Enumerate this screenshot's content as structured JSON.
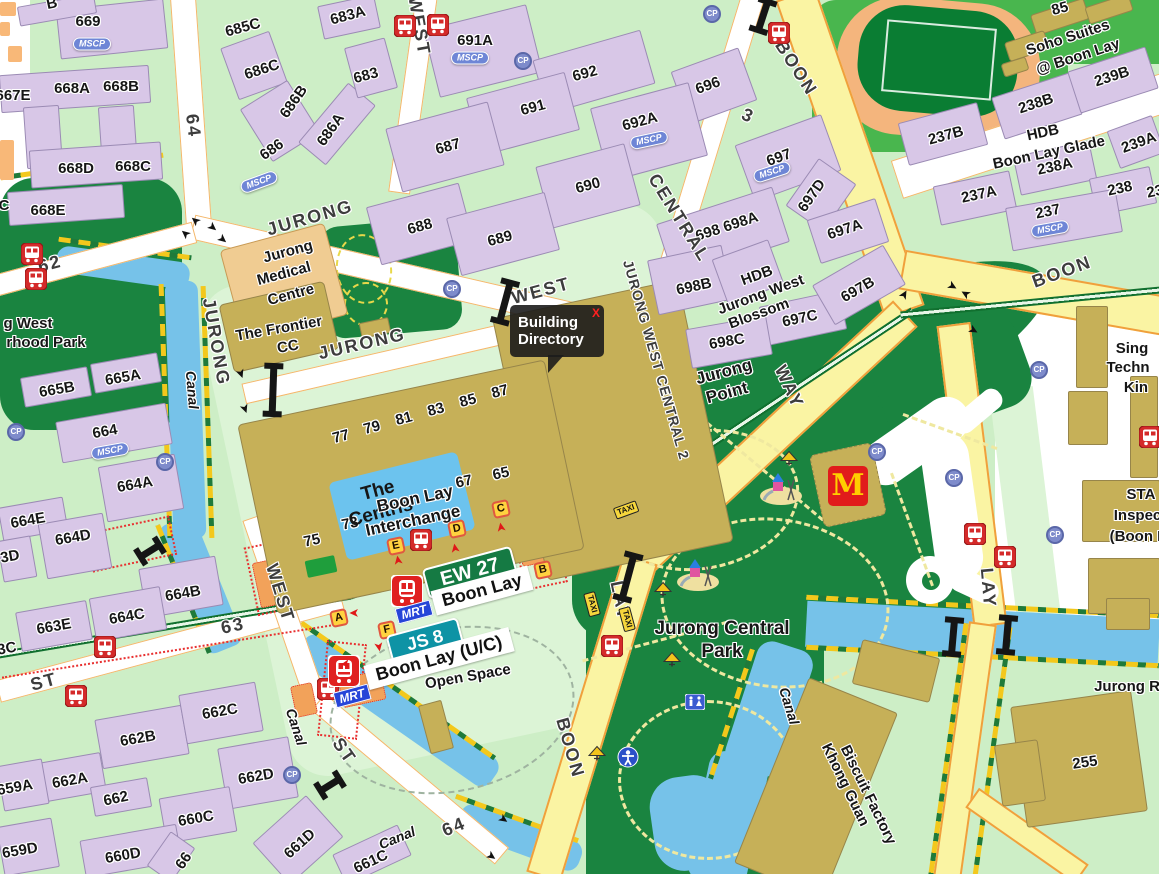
{
  "tooltip": {
    "line1": "Building",
    "line2": "Directory",
    "close": "X"
  },
  "stations": {
    "ew_code": "EW 27",
    "ew_name": "Boon Lay",
    "js_code": "JS 8",
    "js_name": "Boon Lay (U/C)",
    "mrt_label": "MRT"
  },
  "badge_text": {
    "mscp": "MSCP",
    "cp": "CP",
    "taxi": "TAXI",
    "mrtbar": "MRT",
    "mcd": "M"
  },
  "colors": {
    "expressway": "#faf4a3",
    "mrt_line": "#11702f",
    "park": "#1a8440",
    "canal": "#76c2e9",
    "hdb_block": "#d8c7e7",
    "commercial": "#c6b058",
    "ew_line_badge": "#157a43",
    "jrl_badge": "#0e93a5",
    "bus_red": "#d42a2a",
    "mcd_red": "#e11b1b"
  },
  "labels": [
    [
      "B",
      52,
      4,
      -12,
      "blk"
    ],
    [
      "669",
      88,
      22,
      0,
      "blk"
    ],
    [
      "685C",
      243,
      28,
      -15,
      "blk"
    ],
    [
      "683A",
      348,
      16,
      -15,
      "blk"
    ],
    [
      "686C",
      262,
      70,
      -18,
      "blk"
    ],
    [
      "683",
      366,
      76,
      -15,
      "blk"
    ],
    [
      "686B",
      294,
      102,
      -55,
      "blk"
    ],
    [
      "686A",
      331,
      130,
      -55,
      "blk"
    ],
    [
      "686",
      272,
      150,
      -35,
      "blk"
    ],
    [
      "667E",
      13,
      96,
      0,
      "blk"
    ],
    [
      "668A",
      72,
      89,
      0,
      "blk"
    ],
    [
      "668B",
      121,
      87,
      0,
      "blk"
    ],
    [
      "668D",
      76,
      169,
      0,
      "blk"
    ],
    [
      "668C",
      133,
      167,
      0,
      "blk"
    ],
    [
      "C",
      4,
      206,
      0,
      "blk"
    ],
    [
      "668E",
      48,
      211,
      0,
      "blk"
    ],
    [
      "691A",
      475,
      41,
      0,
      "blk"
    ],
    [
      "692",
      585,
      74,
      -15,
      "blk"
    ],
    [
      "691",
      533,
      108,
      -15,
      "blk"
    ],
    [
      "696",
      708,
      86,
      -20,
      "blk"
    ],
    [
      "687",
      448,
      147,
      -15,
      "blk"
    ],
    [
      "692A",
      640,
      122,
      -15,
      "blk"
    ],
    [
      "690",
      588,
      186,
      -15,
      "blk"
    ],
    [
      "688",
      420,
      227,
      -15,
      "blk"
    ],
    [
      "689",
      500,
      239,
      -15,
      "blk"
    ],
    [
      "697",
      779,
      158,
      -20,
      "blk"
    ],
    [
      "697D",
      812,
      196,
      -55,
      "blk"
    ],
    [
      "698 698A",
      727,
      227,
      -18,
      "blk"
    ],
    [
      "697A",
      845,
      230,
      -18,
      "blk"
    ],
    [
      "698B",
      694,
      287,
      -12,
      "blk"
    ],
    [
      "697C",
      800,
      319,
      -12,
      "blk"
    ],
    [
      "697B",
      858,
      290,
      -30,
      "blk"
    ],
    [
      "698C",
      727,
      342,
      -10,
      "blk"
    ],
    [
      "85",
      1060,
      9,
      -15,
      "blk"
    ],
    [
      "239B",
      1112,
      77,
      -18,
      "blk"
    ],
    [
      "238B",
      1036,
      104,
      -18,
      "blk"
    ],
    [
      "237B",
      946,
      136,
      -15,
      "blk"
    ],
    [
      "239A",
      1139,
      143,
      -20,
      "blk"
    ],
    [
      "238A",
      1055,
      167,
      -12,
      "blk"
    ],
    [
      "237A",
      979,
      195,
      -12,
      "blk"
    ],
    [
      "238",
      1120,
      189,
      -12,
      "blk"
    ],
    [
      "23",
      1155,
      192,
      -12,
      "blk"
    ],
    [
      "237",
      1048,
      212,
      -12,
      "blk"
    ],
    [
      "665B",
      57,
      390,
      -10,
      "blk"
    ],
    [
      "665A",
      123,
      378,
      -10,
      "blk"
    ],
    [
      "664",
      105,
      432,
      -10,
      "blk"
    ],
    [
      "664A",
      135,
      485,
      -10,
      "blk"
    ],
    [
      "664E",
      28,
      521,
      -10,
      "blk"
    ],
    [
      "664D",
      73,
      538,
      -10,
      "blk"
    ],
    [
      "3D",
      10,
      557,
      -10,
      "blk"
    ],
    [
      "664B",
      183,
      594,
      -10,
      "blk"
    ],
    [
      "664C",
      127,
      617,
      -10,
      "blk"
    ],
    [
      "663E",
      54,
      627,
      -10,
      "blk"
    ],
    [
      "3C",
      7,
      649,
      -10,
      "blk"
    ],
    [
      "662B",
      138,
      739,
      -10,
      "blk"
    ],
    [
      "662C",
      220,
      712,
      -10,
      "blk"
    ],
    [
      "662A",
      70,
      781,
      -10,
      "blk"
    ],
    [
      "662",
      116,
      799,
      -12,
      "blk"
    ],
    [
      "662D",
      256,
      777,
      -10,
      "blk"
    ],
    [
      "660C",
      196,
      819,
      -10,
      "blk"
    ],
    [
      "660D",
      123,
      856,
      -10,
      "blk"
    ],
    [
      "659A",
      15,
      788,
      -10,
      "blk"
    ],
    [
      "659D",
      20,
      851,
      -10,
      "blk"
    ],
    [
      "661D",
      300,
      844,
      -42,
      "blk"
    ],
    [
      "661C",
      371,
      862,
      -25,
      "blk"
    ],
    [
      "66",
      184,
      861,
      -55,
      "blk"
    ],
    [
      "255",
      1085,
      763,
      -8,
      "blk"
    ],
    [
      "Jurong R",
      1127,
      687,
      0,
      "blk"
    ],
    [
      "77",
      341,
      437,
      -15,
      "blk"
    ],
    [
      "79",
      372,
      428,
      -15,
      "blk"
    ],
    [
      "81",
      404,
      419,
      -15,
      "blk"
    ],
    [
      "83",
      436,
      410,
      -15,
      "blk"
    ],
    [
      "85",
      468,
      401,
      -15,
      "blk"
    ],
    [
      "87",
      500,
      392,
      -15,
      "blk"
    ],
    [
      "75",
      312,
      541,
      -12,
      "blk"
    ],
    [
      "73",
      350,
      524,
      -12,
      "blk"
    ],
    [
      "67",
      464,
      482,
      -12,
      "blk"
    ],
    [
      "65",
      501,
      474,
      -12,
      "blk"
    ],
    [
      "Jurong",
      288,
      252,
      -15,
      "area"
    ],
    [
      "Medical",
      284,
      274,
      -15,
      "area"
    ],
    [
      "Centre",
      291,
      295,
      -15,
      "area"
    ],
    [
      "The Frontier",
      279,
      329,
      -10,
      "area"
    ],
    [
      "CC",
      288,
      347,
      -10,
      "area"
    ],
    [
      "The",
      378,
      491,
      -15,
      "cent"
    ],
    [
      "Centris",
      381,
      513,
      -15,
      "cent"
    ],
    [
      "Boon Lay",
      415,
      499,
      -12,
      "areaL"
    ],
    [
      "Interchange",
      413,
      521,
      -12,
      "areaL"
    ],
    [
      "Jurong",
      724,
      372,
      -15,
      "areaL"
    ],
    [
      "Point",
      727,
      393,
      -15,
      "areaL"
    ],
    [
      "HDB",
      757,
      276,
      -20,
      "area"
    ],
    [
      "Jurong West",
      761,
      295,
      -20,
      "area"
    ],
    [
      "Blossom",
      759,
      314,
      -20,
      "area"
    ],
    [
      "HDB",
      1043,
      133,
      -12,
      "area"
    ],
    [
      "Boon Lay Glade",
      1049,
      153,
      -12,
      "area"
    ],
    [
      "Soho Suites",
      1068,
      38,
      -18,
      "area"
    ],
    [
      "@ Boon Lay",
      1078,
      57,
      -18,
      "area"
    ],
    [
      "Jurong Central",
      722,
      629,
      0,
      "park1"
    ],
    [
      "Park",
      722,
      652,
      0,
      "park1"
    ],
    [
      "Open Space",
      468,
      677,
      -10,
      "area"
    ],
    [
      "g West",
      28,
      324,
      0,
      "area"
    ],
    [
      "rhood Park",
      46,
      343,
      0,
      "area"
    ],
    [
      "Sing",
      1132,
      349,
      0,
      "area"
    ],
    [
      "Techn",
      1128,
      368,
      0,
      "area"
    ],
    [
      "Kin",
      1136,
      388,
      0,
      "area"
    ],
    [
      "STA",
      1141,
      495,
      0,
      "area"
    ],
    [
      "Inspect",
      1140,
      516,
      0,
      "area"
    ],
    [
      "(Boon L",
      1138,
      537,
      0,
      "area"
    ],
    [
      "Khong Guan",
      845,
      785,
      64,
      "fact"
    ],
    [
      "Biscuit Factory",
      868,
      795,
      64,
      "fact"
    ],
    [
      "Canal",
      192,
      390,
      85,
      "canalL"
    ],
    [
      "Canal",
      296,
      727,
      72,
      "canalL"
    ],
    [
      "Canal",
      397,
      838,
      -22,
      "canalL"
    ],
    [
      "Canal",
      789,
      706,
      73,
      "canalL"
    ],
    [
      "64",
      193,
      126,
      83,
      "road"
    ],
    [
      "62",
      50,
      264,
      -15,
      "road"
    ],
    [
      "JURONG",
      216,
      342,
      80,
      "road"
    ],
    [
      "JURONG",
      310,
      218,
      -16,
      "road"
    ],
    [
      "JURONG",
      362,
      344,
      -13,
      "road"
    ],
    [
      "WEST",
      541,
      291,
      -15,
      "road"
    ],
    [
      "WEST",
      419,
      26,
      80,
      "road"
    ],
    [
      "JURONG WEST CENTRAL 2",
      656,
      360,
      74,
      "roadS"
    ],
    [
      "CENTRAL",
      679,
      218,
      58,
      "road"
    ],
    [
      "3",
      748,
      116,
      25,
      "road"
    ],
    [
      "BOON",
      796,
      68,
      57,
      "road"
    ],
    [
      "WAY",
      789,
      387,
      65,
      "road"
    ],
    [
      "LAY",
      620,
      601,
      78,
      "road"
    ],
    [
      "BOON",
      570,
      748,
      74,
      "road"
    ],
    [
      "BOON",
      1062,
      272,
      -20,
      "road"
    ],
    [
      "LAY",
      988,
      588,
      85,
      "road"
    ],
    [
      "WEST",
      280,
      593,
      73,
      "road"
    ],
    [
      "ST",
      44,
      682,
      -15,
      "road"
    ],
    [
      "63",
      233,
      626,
      -12,
      "road"
    ],
    [
      "ST",
      344,
      751,
      55,
      "road"
    ],
    [
      "64",
      454,
      827,
      -22,
      "road"
    ]
  ],
  "badges": [
    [
      "mscp",
      92,
      44,
      0,
      null
    ],
    [
      "mscp",
      259,
      182,
      -20,
      null
    ],
    [
      "mscp",
      470,
      58,
      0,
      null
    ],
    [
      "mscp",
      649,
      140,
      -12,
      null
    ],
    [
      "mscp",
      772,
      172,
      -18,
      null
    ],
    [
      "mscp",
      1050,
      229,
      -10,
      null
    ],
    [
      "mscp",
      110,
      451,
      -10,
      null
    ],
    [
      "cp",
      16,
      432,
      0,
      null
    ],
    [
      "cp",
      165,
      462,
      0,
      null
    ],
    [
      "cp",
      452,
      289,
      0,
      null
    ],
    [
      "cp",
      523,
      61,
      0,
      null
    ],
    [
      "cp",
      712,
      14,
      0,
      null
    ],
    [
      "cp",
      292,
      775,
      0,
      null
    ],
    [
      "cp",
      877,
      452,
      0,
      null
    ],
    [
      "cp",
      954,
      478,
      0,
      null
    ],
    [
      "cp",
      1039,
      370,
      0,
      null
    ],
    [
      "cp",
      1055,
      535,
      0,
      null
    ],
    [
      "bus",
      405,
      26,
      0,
      null
    ],
    [
      "bus",
      438,
      25,
      0,
      null
    ],
    [
      "bus",
      779,
      33,
      0,
      null
    ],
    [
      "bus",
      32,
      254,
      0,
      null
    ],
    [
      "bus",
      36,
      279,
      0,
      null
    ],
    [
      "bus",
      105,
      647,
      0,
      null
    ],
    [
      "bus",
      76,
      696,
      0,
      null
    ],
    [
      "bus",
      612,
      646,
      0,
      null
    ],
    [
      "bus",
      421,
      540,
      0,
      null
    ],
    [
      "bus",
      975,
      534,
      0,
      null
    ],
    [
      "bus",
      1005,
      557,
      0,
      null
    ],
    [
      "bus",
      1150,
      437,
      0,
      null
    ],
    [
      "bus",
      328,
      689,
      0,
      null
    ],
    [
      "train",
      407,
      591,
      0,
      null
    ],
    [
      "train",
      344,
      671,
      0,
      null
    ],
    [
      "mrtbar",
      414,
      612,
      -15,
      null
    ],
    [
      "mrtbar",
      352,
      696,
      -15,
      null
    ],
    [
      "stop",
      396,
      546,
      -12,
      "E"
    ],
    [
      "stop",
      457,
      529,
      -12,
      "D"
    ],
    [
      "stop",
      501,
      509,
      -12,
      "C"
    ],
    [
      "stop",
      543,
      570,
      -12,
      "B"
    ],
    [
      "stop",
      339,
      618,
      -12,
      "A"
    ],
    [
      "stop",
      387,
      630,
      -12,
      "F"
    ],
    [
      "taxi",
      626,
      510,
      -20,
      null
    ],
    [
      "taxi",
      592,
      604,
      75,
      null
    ],
    [
      "taxi",
      627,
      619,
      75,
      null
    ],
    [
      "mcd",
      848,
      486,
      0,
      null
    ],
    [
      "pg",
      781,
      488,
      0,
      null
    ],
    [
      "pg",
      698,
      574,
      0,
      null
    ],
    [
      "shel",
      789,
      459,
      0,
      null
    ],
    [
      "shel",
      663,
      590,
      0,
      null
    ],
    [
      "shel",
      672,
      660,
      0,
      null
    ],
    [
      "shel",
      597,
      754,
      0,
      null
    ],
    [
      "fit",
      628,
      757,
      0,
      null
    ],
    [
      "toi",
      695,
      702,
      0,
      null
    ],
    [
      "bridge",
      505,
      302,
      15,
      40
    ],
    [
      "bridge",
      273,
      390,
      2,
      48
    ],
    [
      "bridge",
      628,
      577,
      15,
      44
    ],
    [
      "bridge",
      763,
      16,
      18,
      30
    ],
    [
      "bridge",
      953,
      637,
      5,
      34
    ],
    [
      "bridge",
      1007,
      635,
      5,
      34
    ],
    [
      "bridge",
      150,
      551,
      58,
      22
    ],
    [
      "bridge",
      330,
      785,
      58,
      22
    ],
    [
      "arr",
      196,
      220,
      -140,
      null
    ],
    [
      "arr",
      212,
      228,
      40,
      null
    ],
    [
      "arr",
      222,
      240,
      40,
      null
    ],
    [
      "arr",
      186,
      233,
      -140,
      null
    ],
    [
      "arr",
      240,
      374,
      70,
      null
    ],
    [
      "arr",
      244,
      409,
      70,
      null
    ],
    [
      "arr",
      952,
      287,
      30,
      null
    ],
    [
      "arr",
      966,
      293,
      -150,
      null
    ],
    [
      "arr",
      973,
      331,
      30,
      null
    ],
    [
      "arr",
      503,
      820,
      35,
      null
    ],
    [
      "arr",
      491,
      857,
      35,
      null
    ],
    [
      "arr",
      905,
      295,
      -60,
      null
    ],
    [
      "arrR",
      399,
      560,
      -100,
      null
    ],
    [
      "arrR",
      456,
      548,
      -100,
      null
    ],
    [
      "arrR",
      502,
      527,
      -100,
      null
    ],
    [
      "arrR",
      354,
      612,
      180,
      null
    ],
    [
      "arrR",
      378,
      647,
      80,
      null
    ],
    [
      "arrR",
      345,
      663,
      170,
      null
    ]
  ]
}
